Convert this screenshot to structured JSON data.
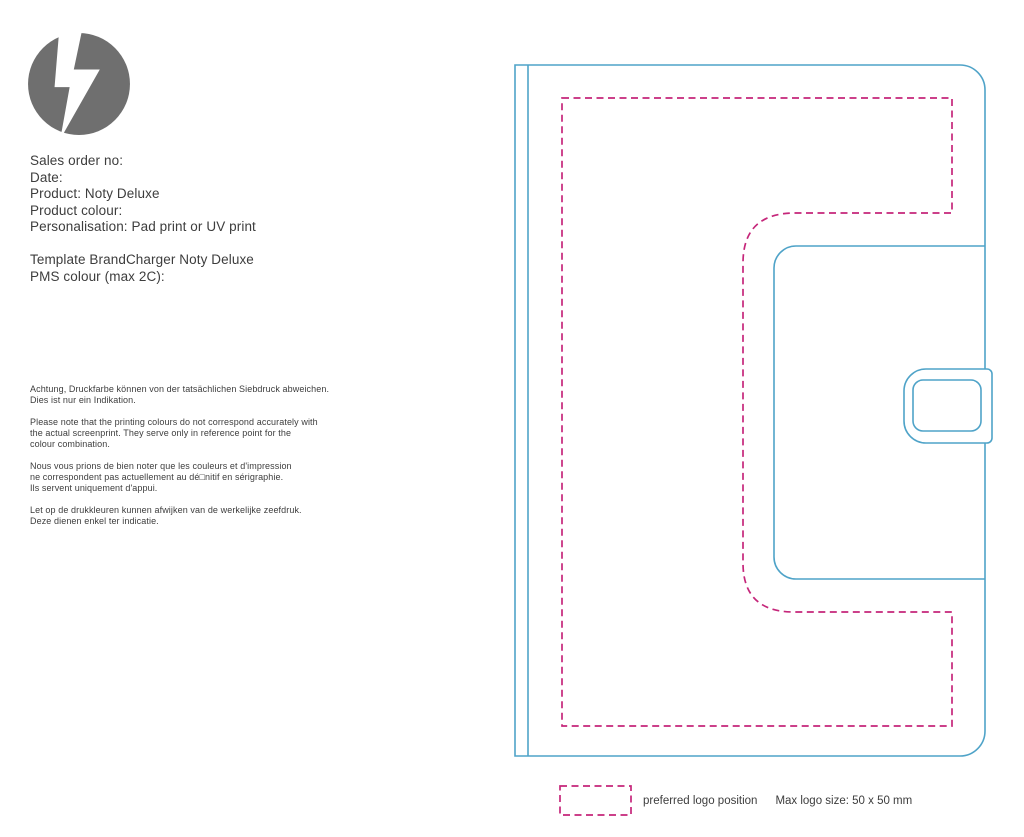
{
  "colors": {
    "outline_cyan": "#4FA3C8",
    "logo_region_magenta": "#C5267A",
    "text_dark": "#3D3D3D",
    "logo_gray": "#6F6F6F"
  },
  "order_info": {
    "lines": [
      "Sales order no:",
      "Date:",
      "Product: Noty Deluxe",
      "Product colour:",
      "Personalisation: Pad print or UV print",
      "",
      "Template BrandCharger Noty Deluxe",
      "PMS colour (max 2C):"
    ]
  },
  "disclaimers": [
    {
      "lang": "de",
      "lines": [
        "Achtung, Druckfarbe können von der tatsächlichen Siebdruck abweichen.",
        "Dies ist nur ein Indikation."
      ]
    },
    {
      "lang": "en",
      "lines": [
        "Please note that the printing colours do not correspond accurately with",
        "the actual screenprint. They serve only in reference point for the",
        "colour combination."
      ]
    },
    {
      "lang": "fr",
      "lines": [
        "Nous vous prions de bien noter que les couleurs et d'impression",
        "ne correspondent pas actuellement au dé□nitif en sérigraphie.",
        "Ils servent uniquement d'appui."
      ]
    },
    {
      "lang": "nl",
      "lines": [
        "Let op de drukkleuren kunnen afwijken van de werkelijke zeefdruk.",
        "Deze dienen enkel ter indicatie."
      ]
    }
  ],
  "legend": {
    "swatch_meaning": "dashed-magenta-rectangle",
    "label": "preferred logo position",
    "max_size": "Max logo size: 50 x 50 mm"
  }
}
